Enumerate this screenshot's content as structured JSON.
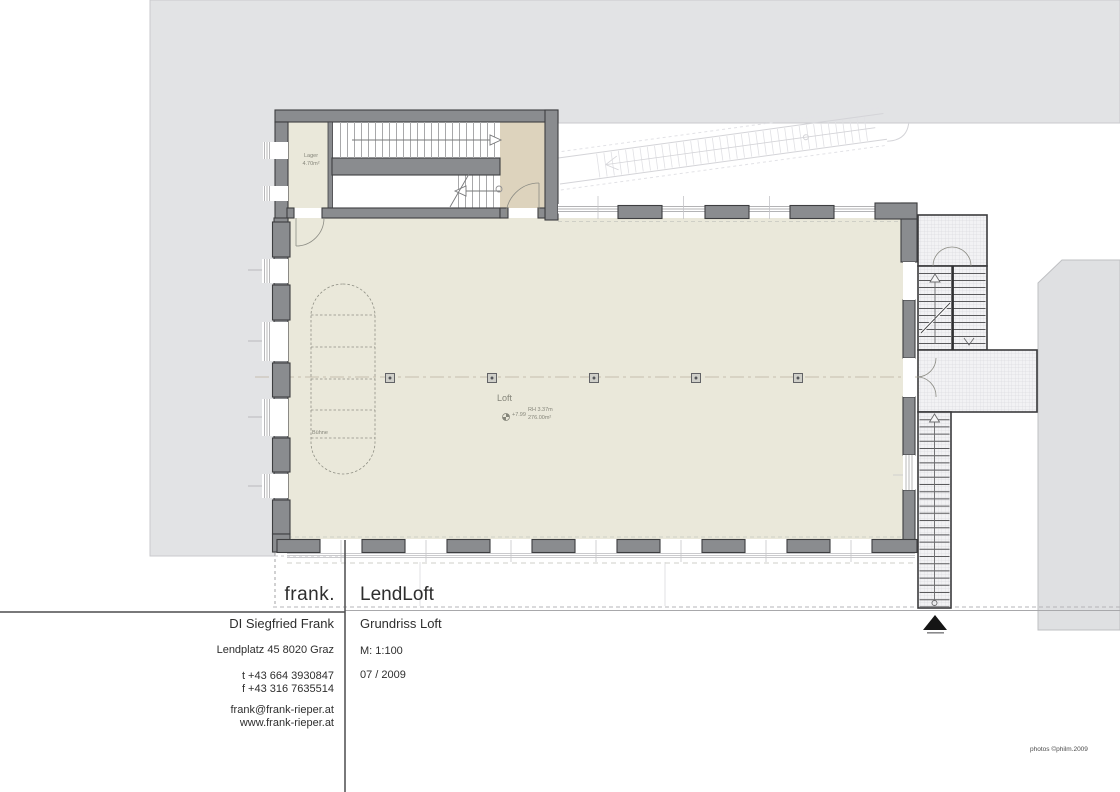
{
  "plan": {
    "labels": {
      "loft": "Loft",
      "loft_level": "+7.99",
      "loft_height": "RH 3.37m",
      "loft_area": "276.00m²",
      "lager": "Lager",
      "lager_area": "4.70m²",
      "buehne": "Bühne"
    },
    "scale_ratio": "1:100"
  },
  "title_block": {
    "logo": "frank.",
    "project": "LendLoft",
    "architect": "DI Siegfried Frank",
    "drawing_title": "Grundriss Loft",
    "address": "Lendplatz 45 8020 Graz",
    "scale": "M: 1:100",
    "phone": "t +43 664 3930847",
    "fax": "f +43 316 7635514",
    "date": "07 / 2009",
    "email": "frank@frank-rieper.at",
    "website": "www.frank-rieper.at"
  },
  "footer": {
    "credit": "photos ©philm.2009"
  },
  "colors": {
    "site_gray": "#e2e3e5",
    "wall_gray": "#8a8c8f",
    "floor_beige": "#eae8da",
    "landing_tan": "#ddd3bd",
    "line_dark": "#3d3e40"
  }
}
